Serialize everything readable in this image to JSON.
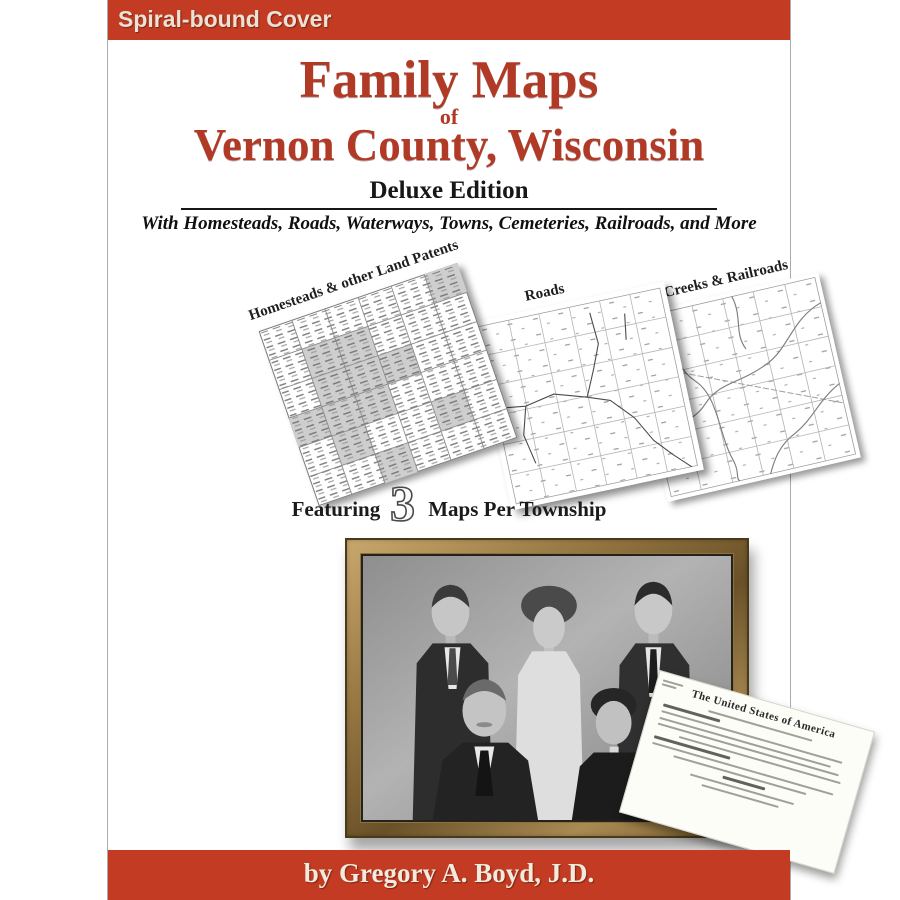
{
  "banner": {
    "label": "Spiral-bound Cover"
  },
  "title": {
    "line1": "Family Maps",
    "of": "of",
    "line2": "Vernon County, Wisconsin",
    "edition": "Deluxe Edition",
    "subtitle": "With Homesteads, Roads, Waterways, Towns, Cemeteries, Railroads, and More"
  },
  "maps": [
    {
      "label": "Homesteads & other Land Patents"
    },
    {
      "label": "Roads"
    },
    {
      "label": "Rivers, Creeks & Railroads"
    }
  ],
  "featuring": {
    "prefix": "Featuring",
    "number": "3",
    "suffix": "Maps Per Township"
  },
  "document": {
    "heading": "The United States of America"
  },
  "author": {
    "byline": "by Gregory A. Boyd, J.D."
  },
  "colors": {
    "accent": "#c23b22",
    "titlered": "#b13a26",
    "ink": "#171717",
    "bannertext": "#e9e2d6"
  }
}
